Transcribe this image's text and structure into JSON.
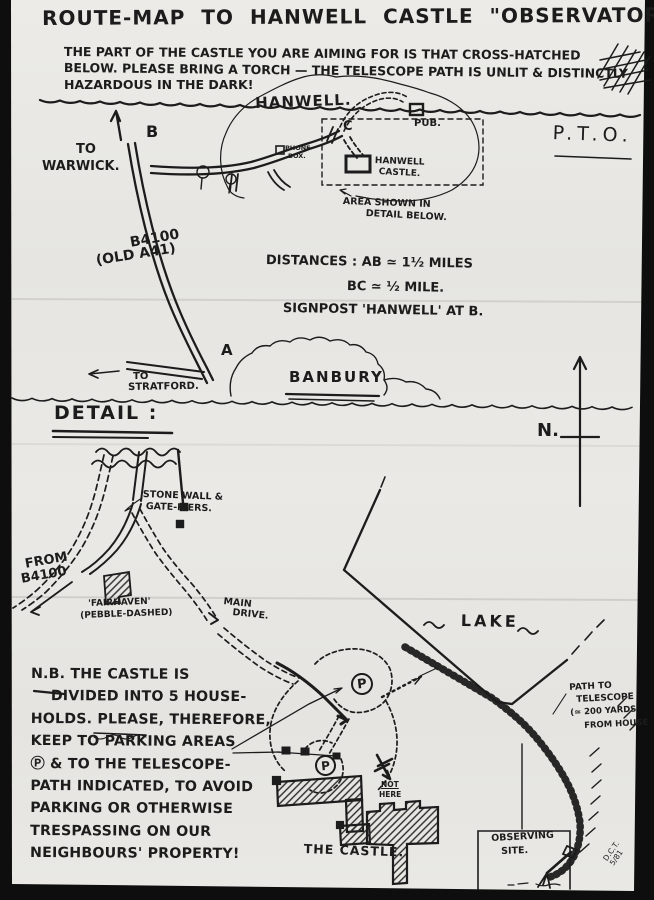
{
  "title": {
    "text": "ROUTE-MAP TO HANWELL CASTLE \"OBSERVATORY\" (!)"
  },
  "intro_note": {
    "line1": "THE PART OF THE CASTLE YOU ARE AIMING FOR IS THAT CROSS-HATCHED",
    "line2": "BELOW. PLEASE BRING A TORCH — THE TELESCOPE PATH IS UNLIT & DISTINCTLY",
    "line3": "HAZARDOUS IN THE DARK!"
  },
  "page": {
    "pto": "P.T.O."
  },
  "overview_map": {
    "to_warwick_line1": "TO",
    "to_warwick_line2": "WARWICK.",
    "point_b": "B",
    "point_c": "C",
    "point_a": "A",
    "village_name": "HANWELL.",
    "phone_box_line1": "PHONE-",
    "phone_box_line2": "BOX.",
    "pub_label": "PUB.",
    "castle_label_line1": "HANWELL",
    "castle_label_line2": "CASTLE.",
    "area_note_line1": "AREA SHOWN IN",
    "area_note_line2": "DETAIL BELOW.",
    "road_label_line1": "B4100",
    "road_label_line2": "(OLD A41)",
    "distances_line1": "DISTANCES : AB ≃ 1½ MILES",
    "distances_line2": "BC ≃ ½ MILE.",
    "signpost_note": "SIGNPOST 'HANWELL' AT B.",
    "to_stratford_line1": "TO",
    "to_stratford_line2": "STRATFORD.",
    "town_name": "BANBURY"
  },
  "detail_section": {
    "heading": "DETAIL :",
    "north_label": "N.",
    "stone_wall_line1": "STONE WALL &",
    "stone_wall_line2": "GATE-PIERS.",
    "from_b4100_line1": "FROM",
    "from_b4100_line2": "B4100",
    "fairhaven_line1": "'FAIRHAVEN'",
    "fairhaven_line2": "(PEBBLE-DASHED)",
    "main_drive_line1": "MAIN",
    "main_drive_line2": "DRIVE.",
    "lake_label": "LAKE",
    "parking_symbol": "P",
    "not_here_line1": "NOT",
    "not_here_line2": "HERE",
    "castle_label": "THE CASTLE.",
    "path_note_line1": "PATH TO",
    "path_note_line2": "TELESCOPE",
    "path_note_line3": "(≃ 200 YARDS",
    "path_note_line4": "FROM HOUSE",
    "observing_line1": "OBSERVING",
    "observing_line2": "SITE.",
    "signature_line1": "D.C.T.",
    "signature_line2": "5/81"
  },
  "nb_note": {
    "lines": [
      "N.B. THE CASTLE IS",
      "DIVIDED INTO 5 HOUSE-",
      "HOLDS. PLEASE, THEREFORE,",
      "KEEP TO PARKING AREAS",
      "Ⓟ & TO THE TELESCOPE-",
      "PATH INDICATED, TO AVOID",
      "PARKING OR OTHERWISE",
      "TRESPASSING ON OUR",
      "NEIGHBOURS' PROPERTY!"
    ]
  },
  "colors": {
    "paper": "#e9e8e4",
    "ink": "#1c1c1c",
    "background": "#0e0e0e"
  }
}
